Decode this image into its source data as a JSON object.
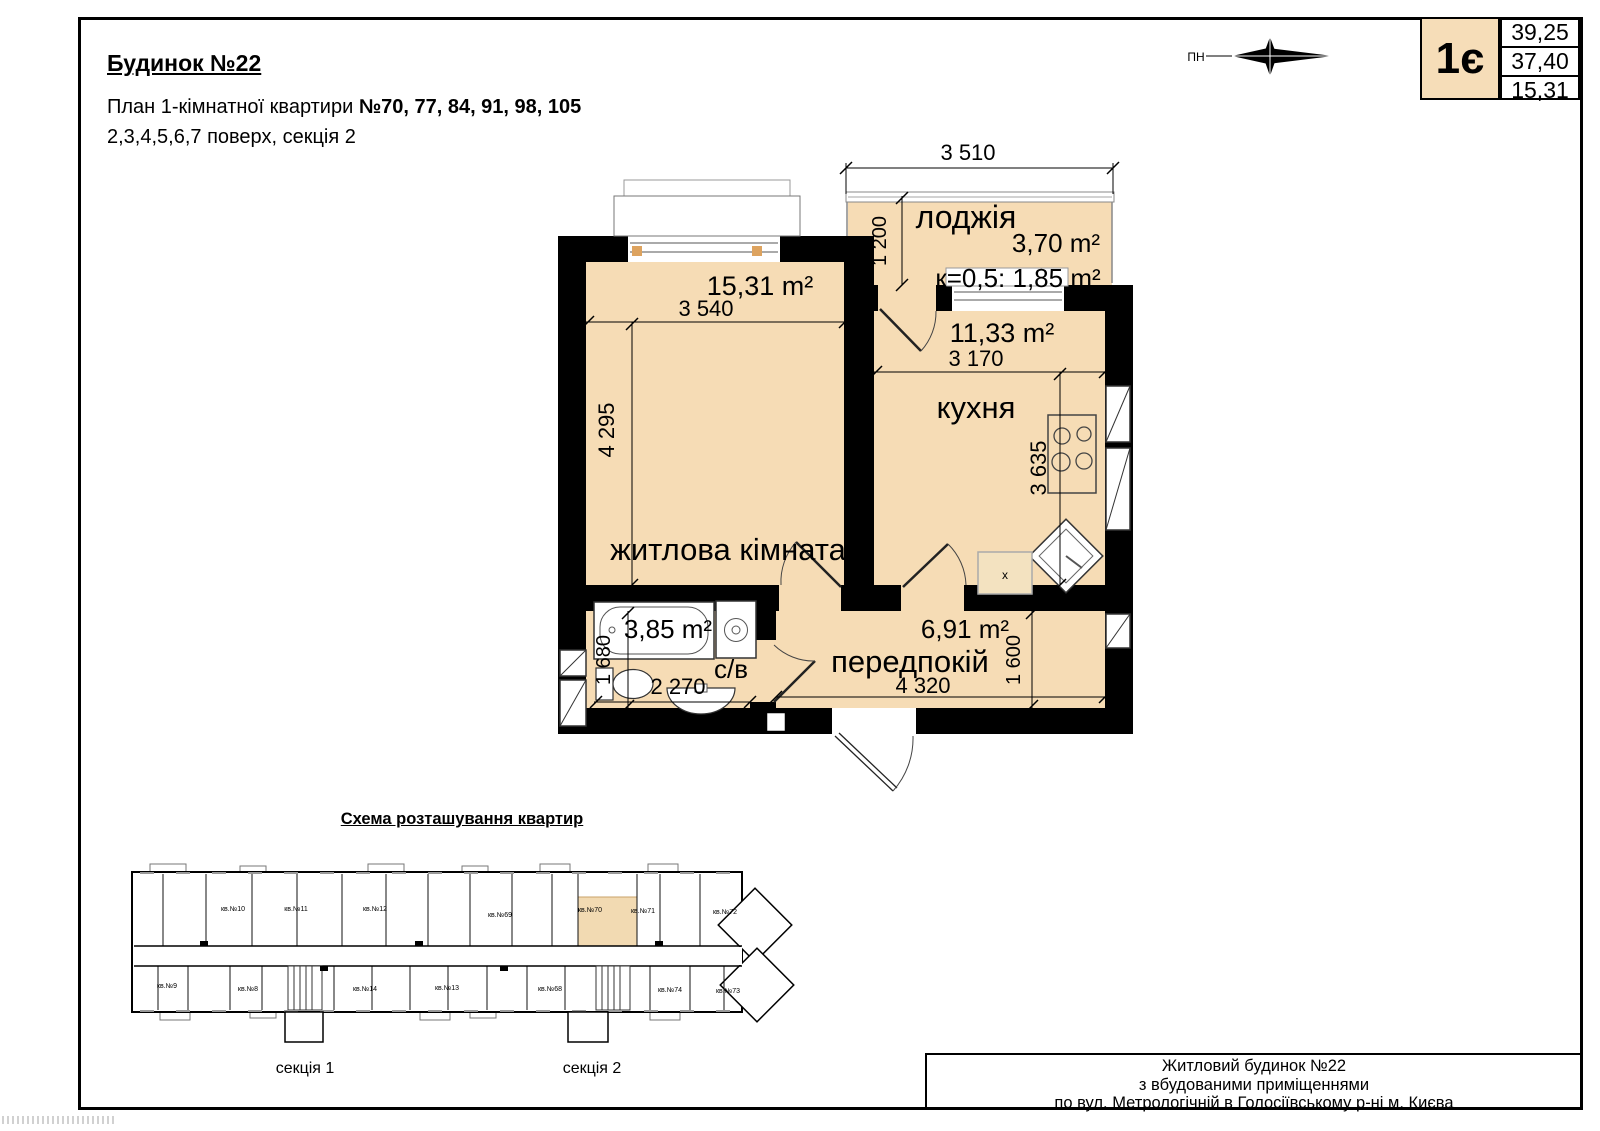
{
  "header": {
    "building": "Будинок №22",
    "plan_line_prefix": "План 1-кімнатної квартири ",
    "plan_line_numbers": "№70, 77, 84, 91, 98, 105",
    "floors_line": "2,3,4,5,6,7 поверх, секція 2"
  },
  "compass": {
    "north_label": "ПН"
  },
  "type_box": {
    "code": "1є",
    "total_area": "39,25",
    "reduced_area": "37,40",
    "living_area": "15,31"
  },
  "plan": {
    "loggia": {
      "label": "лоджія",
      "area": "3,70 m²",
      "coefficient": "к=0,5: 1,85 m²",
      "width_dim": "3 510",
      "depth_dim": "1 200"
    },
    "living_room": {
      "label": "житлова кімната",
      "area": "15,31 m²",
      "width_dim": "3 540",
      "depth_dim": "4 295"
    },
    "kitchen": {
      "label": "кухня",
      "area": "11,33 m²",
      "width_dim": "3 170",
      "depth_dim": "3 635"
    },
    "bathroom": {
      "label": "с/в",
      "area": "3,85 m²",
      "width_dim": "2 270",
      "depth_dim": "1 680"
    },
    "hallway": {
      "label": "передпокій",
      "area": "6,91 m²",
      "width_dim": "4 320",
      "depth_dim": "1 600"
    }
  },
  "schema": {
    "title": "Схема розташування квартир",
    "section1": "секція 1",
    "section2": "секція 2",
    "highlighted": "кв.№70",
    "apartments_top": [
      "кв.№10",
      "кв.№11",
      "кв.№12",
      "кв.№69",
      "кв.№70",
      "кв.№71",
      "кв.№72"
    ],
    "apartments_bottom": [
      "кв.№9",
      "кв.№8",
      "кв.№14",
      "кв.№13",
      "кв.№68",
      "кв.№74",
      "кв.№73"
    ]
  },
  "title_block": {
    "line1": "Житловий будинок  №22",
    "line2": "з вбудованими приміщеннями",
    "line3": "по вул. Метрологічній в Голосіївському р-ні м. Києва"
  },
  "colors": {
    "room_fill": "#f6dcb5",
    "wall": "#000000",
    "highlight_fill": "#f2dab2"
  }
}
